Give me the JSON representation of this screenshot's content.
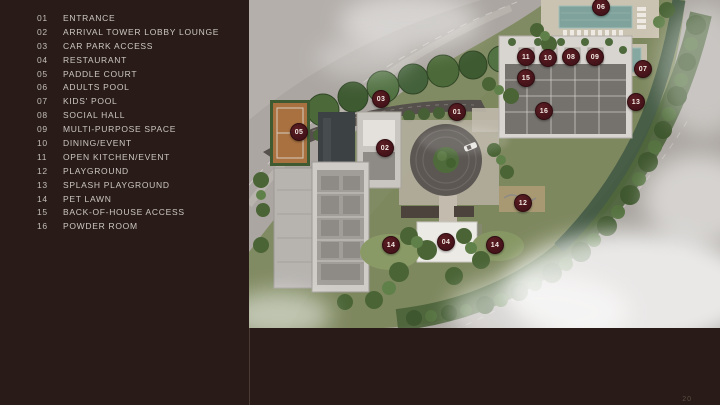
{
  "page": {
    "page_number": "20"
  },
  "colors": {
    "panel_background": "#281b18",
    "legend_text": "#cdc7c2",
    "marker_fill": "#45131a",
    "marker_text": "#f2e8e3",
    "pool_water": "#7fa39c",
    "paddle_court": "#a97140"
  },
  "legend": {
    "items": [
      {
        "num": "01",
        "label": "ENTRANCE"
      },
      {
        "num": "02",
        "label": "ARRIVAL TOWER LOBBY LOUNGE"
      },
      {
        "num": "03",
        "label": "CAR PARK ACCESS"
      },
      {
        "num": "04",
        "label": "RESTAURANT"
      },
      {
        "num": "05",
        "label": "PADDLE COURT"
      },
      {
        "num": "06",
        "label": "ADULTS POOL"
      },
      {
        "num": "07",
        "label": "KIDS' POOL"
      },
      {
        "num": "08",
        "label": "SOCIAL HALL"
      },
      {
        "num": "09",
        "label": "MULTI-PURPOSE SPACE"
      },
      {
        "num": "10",
        "label": "DINING/EVENT"
      },
      {
        "num": "11",
        "label": "OPEN KITCHEN/EVENT"
      },
      {
        "num": "12",
        "label": "PLAYGROUND"
      },
      {
        "num": "13",
        "label": "SPLASH PLAYGROUND"
      },
      {
        "num": "14",
        "label": "PET LAWN"
      },
      {
        "num": "15",
        "label": "BACK-OF-HOUSE ACCESS"
      },
      {
        "num": "16",
        "label": "POWDER ROOM"
      }
    ]
  },
  "site_plan": {
    "markers": [
      {
        "label": "01",
        "x": 457,
        "y": 112
      },
      {
        "label": "02",
        "x": 385,
        "y": 148
      },
      {
        "label": "03",
        "x": 381,
        "y": 99
      },
      {
        "label": "04",
        "x": 446,
        "y": 242
      },
      {
        "label": "05",
        "x": 299,
        "y": 132
      },
      {
        "label": "06",
        "x": 601,
        "y": 7
      },
      {
        "label": "07",
        "x": 643,
        "y": 69
      },
      {
        "label": "08",
        "x": 571,
        "y": 57
      },
      {
        "label": "09",
        "x": 595,
        "y": 57
      },
      {
        "label": "10",
        "x": 548,
        "y": 58
      },
      {
        "label": "11",
        "x": 526,
        "y": 57
      },
      {
        "label": "12",
        "x": 523,
        "y": 203
      },
      {
        "label": "13",
        "x": 636,
        "y": 102
      },
      {
        "label": "14",
        "x": 391,
        "y": 245
      },
      {
        "label": "14",
        "x": 495,
        "y": 245
      },
      {
        "label": "15",
        "x": 526,
        "y": 78
      },
      {
        "label": "16",
        "x": 544,
        "y": 111
      }
    ]
  }
}
